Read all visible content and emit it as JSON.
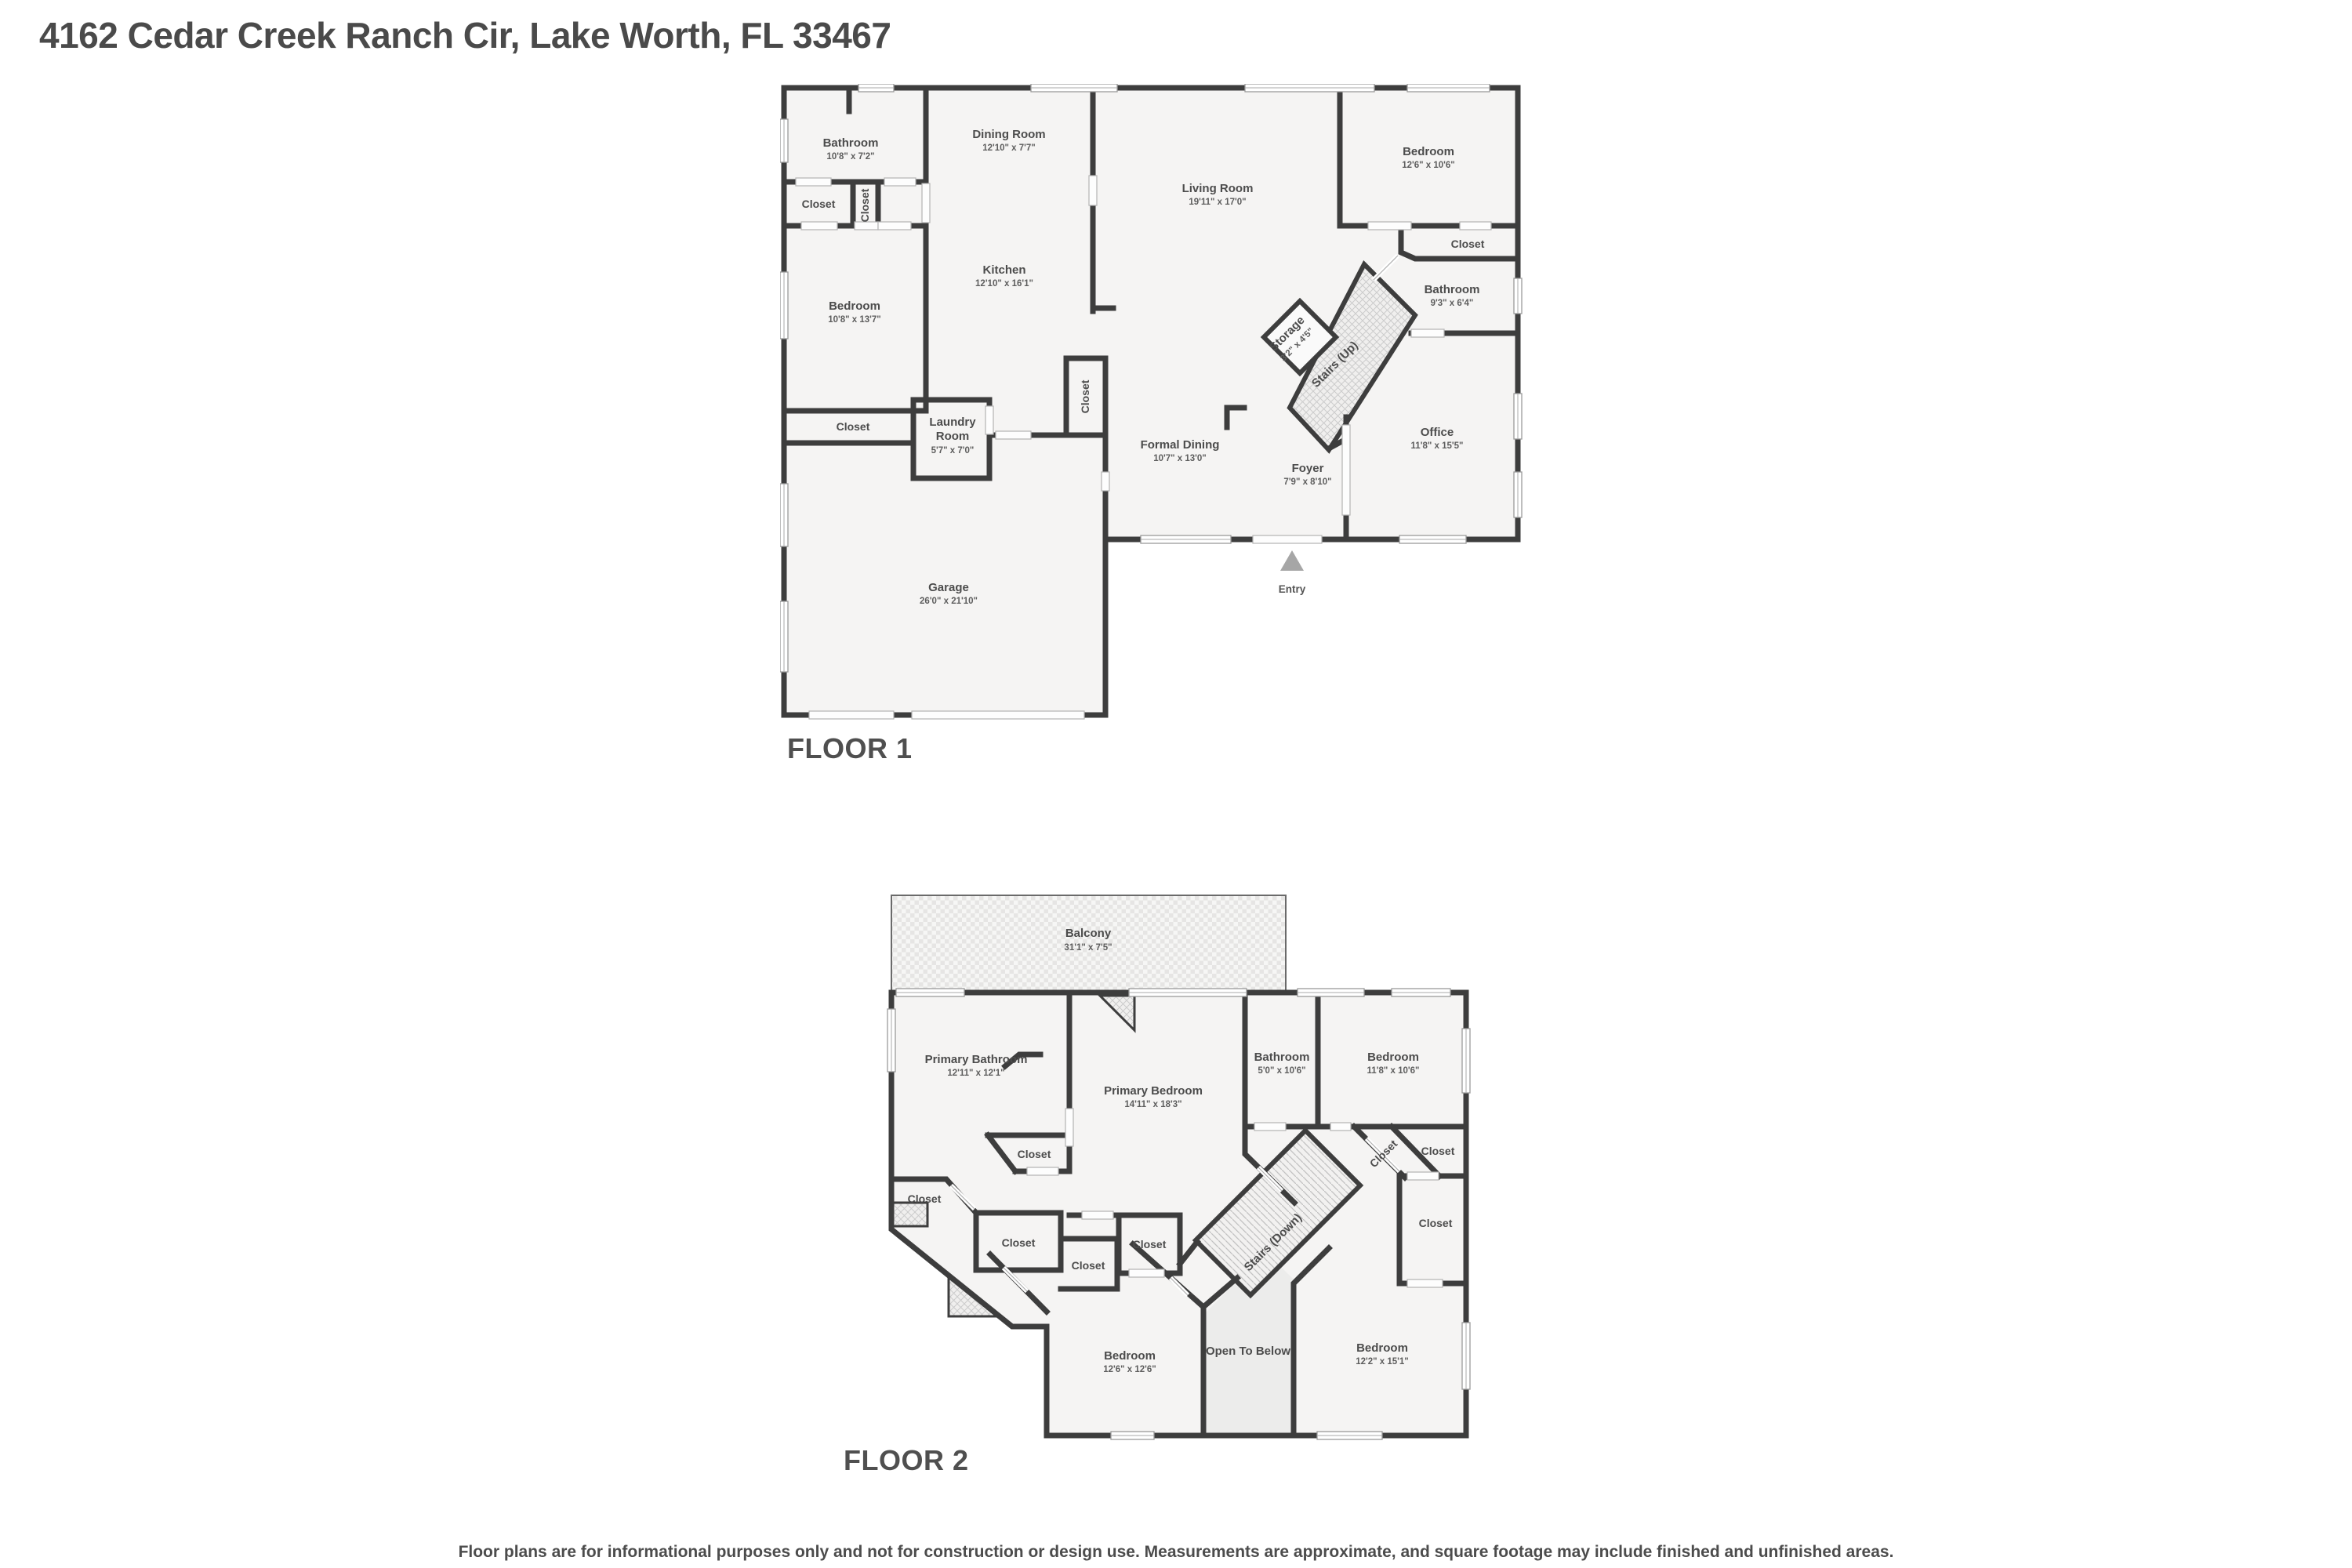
{
  "page": {
    "title": "4162 Cedar Creek Ranch Cir, Lake Worth, FL 33467",
    "floor1_label": "FLOOR 1",
    "floor2_label": "FLOOR 2",
    "disclaimer": "Floor plans are for informational purposes only and not for construction or design use. Measurements are approximate, and square footage may include finished and unfinished areas."
  },
  "floor1": {
    "entry": "Entry",
    "rooms": {
      "bathroom1": {
        "name": "Bathroom",
        "dims": "10'8\" x 7'2\""
      },
      "closet_hall": {
        "name": "Closet"
      },
      "closet_hall_vertical": {
        "name": "Closet"
      },
      "dining": {
        "name": "Dining Room",
        "dims": "12'10\" x 7'7\""
      },
      "living": {
        "name": "Living Room",
        "dims": "19'11\" x 17'0\""
      },
      "bedroom_right": {
        "name": "Bedroom",
        "dims": "12'6\" x 10'6\""
      },
      "closet_bedroom_right": {
        "name": "Closet"
      },
      "bathroom2": {
        "name": "Bathroom",
        "dims": "9'3\" x 6'4\""
      },
      "storage": {
        "name": "Storage",
        "dims": "3'2\" x 4'5\""
      },
      "stairs_up": {
        "name": "Stairs (Up)"
      },
      "kitchen": {
        "name": "Kitchen",
        "dims": "12'10\" x 16'1\""
      },
      "bedroom_left": {
        "name": "Bedroom",
        "dims": "10'8\" x 13'7\""
      },
      "closet_bedroom_left": {
        "name": "Closet"
      },
      "laundry": {
        "line1": "Laundry",
        "line2": "Room",
        "dims": "5'7\" x 7'0\""
      },
      "closet_mid": {
        "name": "Closet"
      },
      "formal_dining": {
        "name": "Formal Dining",
        "dims": "10'7\" x 13'0\""
      },
      "foyer": {
        "name": "Foyer",
        "dims": "7'9\" x 8'10\""
      },
      "office": {
        "name": "Office",
        "dims": "11'8\" x 15'5\""
      },
      "garage": {
        "name": "Garage",
        "dims": "26'0\" x 21'10\""
      }
    }
  },
  "floor2": {
    "rooms": {
      "balcony": {
        "name": "Balcony",
        "dims": "31'1\" x 7'5\""
      },
      "primary_bathroom": {
        "name": "Primary Bathroom",
        "dims": "12'11\" x 12'1\""
      },
      "primary_bedroom": {
        "name": "Primary Bedroom",
        "dims": "14'11\" x 18'3\""
      },
      "bathroom": {
        "name": "Bathroom",
        "dims": "5'0\" x 10'6\""
      },
      "bedroom_tr": {
        "name": "Bedroom",
        "dims": "11'8\" x 10'6\""
      },
      "closet_pb": {
        "name": "Closet"
      },
      "closet_pentagon": {
        "name": "Closet"
      },
      "closet_bp": {
        "name": "Closet"
      },
      "closet_small": {
        "name": "Closet"
      },
      "closet_mid": {
        "name": "Closet"
      },
      "closet_diag": {
        "name": "Closet"
      },
      "closet_r1": {
        "name": "Closet"
      },
      "closet_r2": {
        "name": "Closet"
      },
      "stairs_down": {
        "name": "Stairs (Down)"
      },
      "bedroom_bl": {
        "name": "Bedroom",
        "dims": "12'6\" x 12'6\""
      },
      "open_below": {
        "name": "Open To Below"
      },
      "bedroom_br": {
        "name": "Bedroom",
        "dims": "12'2\" x 15'1\""
      }
    }
  }
}
